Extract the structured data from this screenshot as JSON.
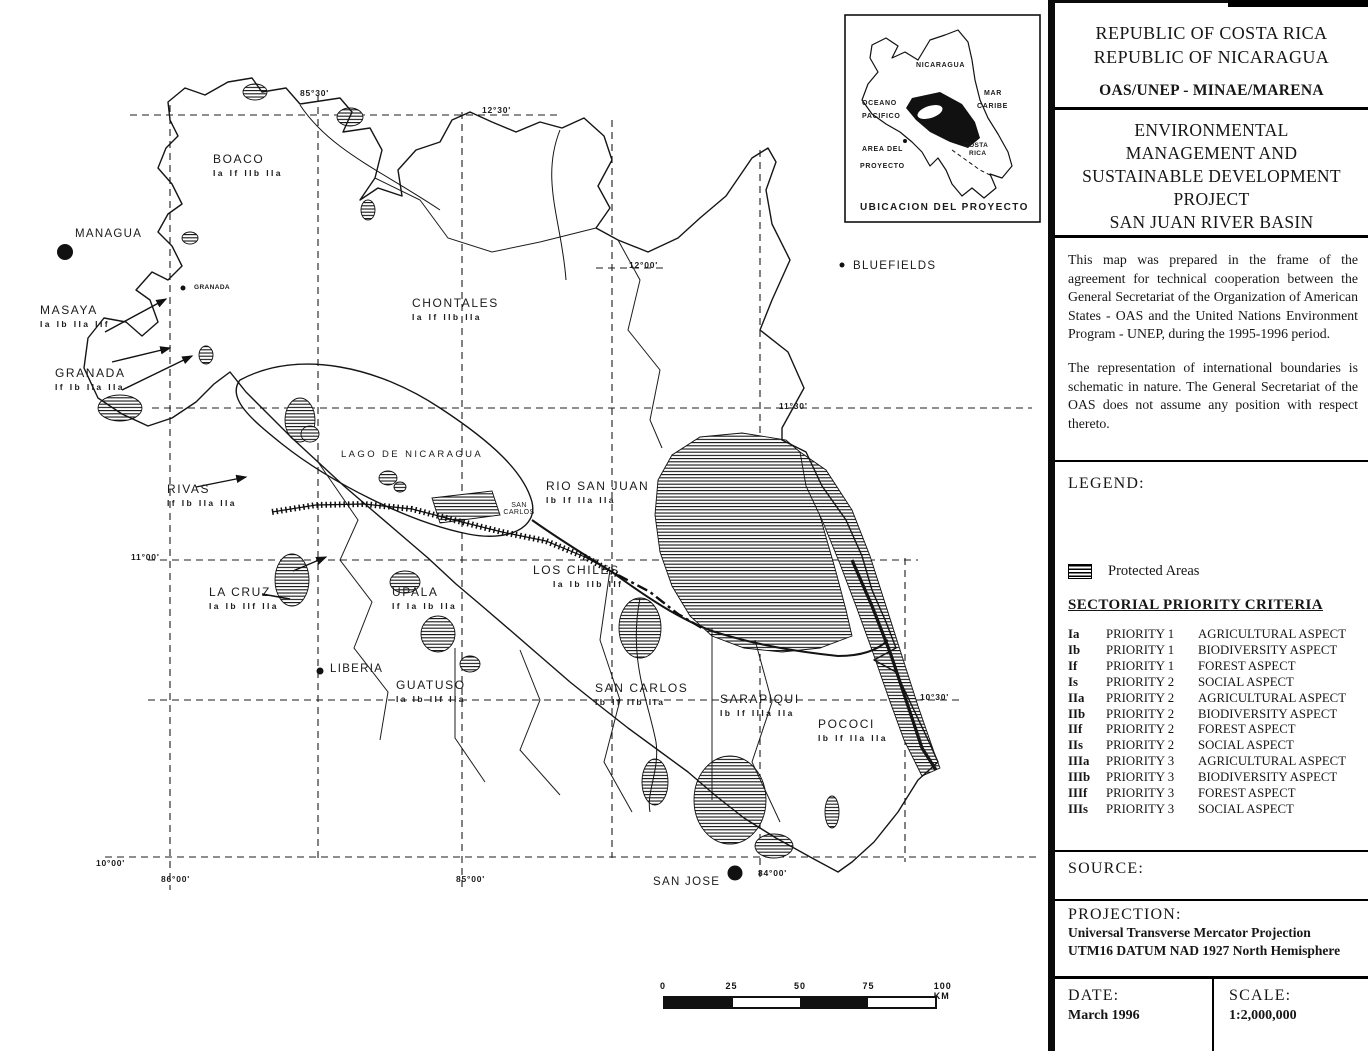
{
  "colors": {
    "ink": "#161616",
    "paper": "#ffffff"
  },
  "panel": {
    "header": {
      "line1": "REPUBLIC OF COSTA RICA",
      "line2": "REPUBLIC OF NICARAGUA",
      "org": "OAS/UNEP - MINAE/MARENA",
      "project_title_lines": [
        "ENVIRONMENTAL",
        "MANAGEMENT AND",
        "SUSTAINABLE DEVELOPMENT",
        "PROJECT",
        "SAN JUAN RIVER BASIN"
      ]
    },
    "notes": [
      "This map was prepared in the frame of the agreement for technical cooperation between the General Secretariat of the Organization of American States - OAS and the United Nations Environment Program - UNEP, during the 1995-1996 period.",
      "The representation of international boundaries is schematic in nature.  The General Secretariat of the OAS does not assume any position with respect thereto."
    ],
    "legend": {
      "heading": "LEGEND:",
      "protected_areas_label": "Protected Areas",
      "criteria_heading": "SECTORIAL PRIORITY CRITERIA",
      "criteria": [
        {
          "code": "Ia",
          "priority": "PRIORITY 1",
          "aspect": "AGRICULTURAL ASPECT"
        },
        {
          "code": "Ib",
          "priority": "PRIORITY 1",
          "aspect": "BIODIVERSITY ASPECT"
        },
        {
          "code": "If",
          "priority": "PRIORITY 1",
          "aspect": "FOREST ASPECT"
        },
        {
          "code": "Is",
          "priority": "PRIORITY 2",
          "aspect": "SOCIAL ASPECT"
        },
        {
          "code": "IIa",
          "priority": "PRIORITY 2",
          "aspect": "AGRICULTURAL ASPECT"
        },
        {
          "code": "IIb",
          "priority": "PRIORITY 2",
          "aspect": "BIODIVERSITY ASPECT"
        },
        {
          "code": "IIf",
          "priority": "PRIORITY 2",
          "aspect": "FOREST ASPECT"
        },
        {
          "code": "IIs",
          "priority": "PRIORITY 2",
          "aspect": "SOCIAL ASPECT"
        },
        {
          "code": "IIIa",
          "priority": "PRIORITY 3",
          "aspect": "AGRICULTURAL ASPECT"
        },
        {
          "code": "IIIb",
          "priority": "PRIORITY 3",
          "aspect": "BIODIVERSITY ASPECT"
        },
        {
          "code": "IIIf",
          "priority": "PRIORITY 3",
          "aspect": "FOREST ASPECT"
        },
        {
          "code": "IIIs",
          "priority": "PRIORITY 3",
          "aspect": "SOCIAL ASPECT"
        }
      ]
    },
    "source_label": "SOURCE:",
    "projection": {
      "label": "PROJECTION:",
      "line1": "Universal Transverse Mercator Projection",
      "line2": "UTM16 DATUM NAD 1927 North Hemisphere"
    },
    "date": {
      "label": "DATE:",
      "value": "March 1996"
    },
    "scale": {
      "label": "SCALE:",
      "value": "1:2,000,000"
    }
  },
  "map": {
    "labels": [
      {
        "name": "label-boaco",
        "text": "BOACO",
        "codes": "Ia If IIb IIa",
        "x": 213,
        "y": 152,
        "cls": "region"
      },
      {
        "name": "label-chontales",
        "text": "CHONTALES",
        "codes": "Ia If IIb IIa",
        "x": 412,
        "y": 296,
        "cls": "region"
      },
      {
        "name": "label-masaya",
        "text": "MASAYA",
        "codes": "Ia Ib IIa IIf",
        "x": 40,
        "y": 303,
        "cls": "region"
      },
      {
        "name": "label-granada",
        "text": "GRANADA",
        "codes": "If Ib IIa IIa",
        "x": 55,
        "y": 366,
        "cls": "region"
      },
      {
        "name": "label-rivas",
        "text": "RIVAS",
        "codes": "If Ib IIa IIa",
        "x": 167,
        "y": 482,
        "cls": "region"
      },
      {
        "name": "label-rio-san-juan",
        "text": "RIO SAN JUAN",
        "codes": "Ib If IIa IIa",
        "x": 546,
        "y": 479,
        "cls": "region"
      },
      {
        "name": "label-los-chiles",
        "text": "LOS CHILES",
        "codes": "Ia Ib IIb IIf",
        "x": 533,
        "y": 563,
        "cls": "region",
        "codes_dx": 20
      },
      {
        "name": "label-la-cruz",
        "text": "LA CRUZ",
        "codes": "Ia Ib IIf IIa",
        "x": 209,
        "y": 585,
        "cls": "region"
      },
      {
        "name": "label-upala",
        "text": "UPALA",
        "codes": "If Ia Ib IIa",
        "x": 392,
        "y": 585,
        "cls": "region"
      },
      {
        "name": "label-guatuso",
        "text": "GUATUSO",
        "codes": "Ia Ib IIf IIa",
        "x": 396,
        "y": 678,
        "cls": "region"
      },
      {
        "name": "label-san-carlos",
        "text": "SAN CARLOS",
        "codes": "Ib If IIb IIa",
        "x": 595,
        "y": 681,
        "cls": "region"
      },
      {
        "name": "label-sarapiqui",
        "text": "SARAPIQUI",
        "codes": "Ib If IIIa IIa",
        "x": 720,
        "y": 692,
        "cls": "region"
      },
      {
        "name": "label-pococi",
        "text": "POCOCI",
        "codes": "Ib If IIa IIa",
        "x": 818,
        "y": 717,
        "cls": "region"
      },
      {
        "name": "label-lago-de-nicaragua",
        "text": "LAGO DE NICARAGUA",
        "x": 341,
        "y": 449,
        "cls": "water"
      },
      {
        "name": "label-managua",
        "text": "MANAGUA",
        "x": 75,
        "y": 228,
        "cls": "city"
      },
      {
        "name": "label-granada-town",
        "text": "GRANADA",
        "x": 194,
        "y": 284,
        "cls": "microtown"
      },
      {
        "name": "label-san-carlos-town",
        "text": "SAN CARLOS",
        "x": 496,
        "y": 502,
        "cls": "microtown2"
      },
      {
        "name": "label-liberia",
        "text": "LIBERIA",
        "x": 330,
        "y": 663,
        "cls": "city"
      },
      {
        "name": "label-san-jose",
        "text": "SAN JOSE",
        "x": 653,
        "y": 876,
        "cls": "city"
      },
      {
        "name": "label-bluefields",
        "text": "BLUEFIELDS",
        "x": 853,
        "y": 260,
        "cls": "city"
      },
      {
        "name": "grid-label-85-30",
        "text": "85°30'",
        "x": 300,
        "y": 88,
        "cls": "coord"
      },
      {
        "name": "grid-label-12-30",
        "text": "12°30'",
        "x": 482,
        "y": 105,
        "cls": "coord"
      },
      {
        "name": "grid-label-12-00",
        "text": "12°00'",
        "x": 629,
        "y": 260,
        "cls": "coord"
      },
      {
        "name": "grid-label-11-30",
        "text": "11°30'",
        "x": 779,
        "y": 401,
        "cls": "coord"
      },
      {
        "name": "grid-label-11-00",
        "text": "11°00'",
        "x": 131,
        "y": 552,
        "cls": "coord"
      },
      {
        "name": "grid-label-10-30",
        "text": "10°30'",
        "x": 920,
        "y": 692,
        "cls": "coord"
      },
      {
        "name": "grid-label-10-00",
        "text": "10°00'",
        "x": 96,
        "y": 858,
        "cls": "coord"
      },
      {
        "name": "grid-label-86-00",
        "text": "86°00'",
        "x": 161,
        "y": 874,
        "cls": "coord"
      },
      {
        "name": "grid-label-85-00",
        "text": "85°00'",
        "x": 456,
        "y": 874,
        "cls": "coord"
      },
      {
        "name": "grid-label-84-00",
        "text": "84°00'",
        "x": 758,
        "y": 868,
        "cls": "coord"
      },
      {
        "name": "inset-label-nicaragua",
        "text": "NICARAGUA",
        "x": 916,
        "y": 62,
        "cls": "inset-tiny"
      },
      {
        "name": "inset-label-oceano",
        "text": "OCEANO",
        "x": 862,
        "y": 100,
        "cls": "inset-tiny"
      },
      {
        "name": "inset-label-pacifico",
        "text": "PACIFICO",
        "x": 862,
        "y": 113,
        "cls": "inset-tiny"
      },
      {
        "name": "inset-label-mar",
        "text": "MAR",
        "x": 984,
        "y": 90,
        "cls": "inset-tiny"
      },
      {
        "name": "inset-label-caribe",
        "text": "CARIBE",
        "x": 977,
        "y": 103,
        "cls": "inset-tiny"
      },
      {
        "name": "inset-label-area-del",
        "text": "AREA DEL",
        "x": 862,
        "y": 146,
        "cls": "inset-tiny"
      },
      {
        "name": "inset-label-proyecto",
        "text": "PROYECTO",
        "x": 860,
        "y": 163,
        "cls": "inset-tiny"
      },
      {
        "name": "inset-label-costa",
        "text": "COSTA",
        "x": 964,
        "y": 142,
        "cls": "microtown"
      },
      {
        "name": "inset-label-rica",
        "text": "RICA",
        "x": 969,
        "y": 150,
        "cls": "microtown"
      },
      {
        "name": "inset-label-caption",
        "text": "UBICACION DEL PROYECTO",
        "x": 860,
        "y": 202,
        "cls": "inset-caption"
      }
    ],
    "scalebar": {
      "ticks": [
        "0",
        "25",
        "50",
        "75",
        "100 KM"
      ]
    }
  }
}
